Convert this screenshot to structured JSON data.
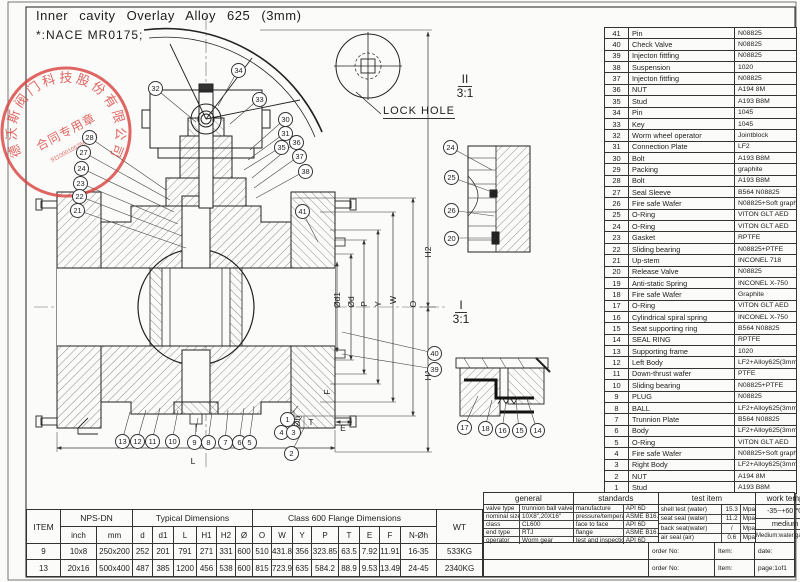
{
  "notes": {
    "line1": "Inner cavity Overlay Alloy 625 (3mm)",
    "line2": "*:NACE MR0175;"
  },
  "stamp": {
    "ring_text": "德沃斯阀门科技股份有限公司",
    "center_text": "合同专用章",
    "number_text": "91100010525062Z7",
    "color": "#d9413d"
  },
  "drawing": {
    "lock_hole_label": "LOCK HOLE",
    "detail_ii": {
      "name": "II",
      "scale": "3:1"
    },
    "detail_i": {
      "name": "I",
      "scale": "3:1"
    },
    "dim_labels": [
      {
        "t": "Ød1",
        "x": 337,
        "y": 300,
        "rot": 1
      },
      {
        "t": "Ød",
        "x": 351,
        "y": 302,
        "rot": 1
      },
      {
        "t": "P",
        "x": 364,
        "y": 304,
        "rot": 1
      },
      {
        "t": "Y",
        "x": 378,
        "y": 304,
        "rot": 1
      },
      {
        "t": "W",
        "x": 393,
        "y": 300,
        "rot": 1
      },
      {
        "t": "O",
        "x": 413,
        "y": 304,
        "rot": 1
      },
      {
        "t": "H2",
        "x": 428,
        "y": 252,
        "rot": 1
      },
      {
        "t": "H1",
        "x": 428,
        "y": 375,
        "rot": 1
      },
      {
        "t": "N-Øh",
        "x": 297,
        "y": 426,
        "rot": 1
      },
      {
        "t": "F",
        "x": 327,
        "y": 392,
        "rot": 1
      },
      {
        "t": "T",
        "x": 311,
        "y": 422,
        "rot": 0
      },
      {
        "t": "E",
        "x": 343,
        "y": 428,
        "rot": 0
      },
      {
        "t": "L",
        "x": 193,
        "y": 461,
        "rot": 0
      }
    ],
    "balloons": [
      {
        "n": 32,
        "x": 155,
        "y": 88,
        "tx": 196,
        "ty": 122
      },
      {
        "n": 34,
        "x": 238,
        "y": 70,
        "tx": 218,
        "ty": 106
      },
      {
        "n": 33,
        "x": 259,
        "y": 99,
        "tx": 230,
        "ty": 124
      },
      {
        "n": 28,
        "x": 89,
        "y": 137,
        "tx": 166,
        "ty": 190
      },
      {
        "n": 27,
        "x": 83,
        "y": 152,
        "tx": 170,
        "ty": 200
      },
      {
        "n": 24,
        "x": 81,
        "y": 168,
        "tx": 174,
        "ty": 212
      },
      {
        "n": 23,
        "x": 80,
        "y": 183,
        "tx": 178,
        "ty": 224
      },
      {
        "n": 22,
        "x": 79,
        "y": 196,
        "tx": 182,
        "ty": 236
      },
      {
        "n": 21,
        "x": 77,
        "y": 210,
        "tx": 186,
        "ty": 248
      },
      {
        "n": 30,
        "x": 285,
        "y": 119,
        "tx": 250,
        "ty": 150
      },
      {
        "n": 31,
        "x": 285,
        "y": 133,
        "tx": 248,
        "ty": 160
      },
      {
        "n": 35,
        "x": 281,
        "y": 147,
        "tx": 244,
        "ty": 170
      },
      {
        "n": 36,
        "x": 296,
        "y": 142,
        "tx": 252,
        "ty": 178
      },
      {
        "n": 37,
        "x": 299,
        "y": 156,
        "tx": 254,
        "ty": 188
      },
      {
        "n": 38,
        "x": 305,
        "y": 171,
        "tx": 256,
        "ty": 198
      },
      {
        "n": 41,
        "x": 302,
        "y": 211,
        "tx": 318,
        "ty": 242
      },
      {
        "n": 40,
        "x": 434,
        "y": 353,
        "tx": 342,
        "ty": 332
      },
      {
        "n": 39,
        "x": 434,
        "y": 369,
        "tx": 342,
        "ty": 354
      },
      {
        "n": 13,
        "x": 122,
        "y": 441,
        "tx": 130,
        "ty": 412
      },
      {
        "n": 12,
        "x": 137,
        "y": 441,
        "tx": 146,
        "ty": 410
      },
      {
        "n": 11,
        "x": 152,
        "y": 441,
        "tx": 160,
        "ty": 408
      },
      {
        "n": 10,
        "x": 172,
        "y": 441,
        "tx": 178,
        "ty": 410
      },
      {
        "n": 9,
        "x": 194,
        "y": 442,
        "tx": 198,
        "ty": 418
      },
      {
        "n": 8,
        "x": 208,
        "y": 442,
        "tx": 212,
        "ty": 412
      },
      {
        "n": 7,
        "x": 225,
        "y": 442,
        "tx": 228,
        "ty": 410
      },
      {
        "n": 6,
        "x": 239,
        "y": 442,
        "tx": 244,
        "ty": 408
      },
      {
        "n": 5,
        "x": 249,
        "y": 442,
        "tx": 254,
        "ty": 406
      },
      {
        "n": 4,
        "x": 281,
        "y": 432,
        "tx": 292,
        "ty": 414
      },
      {
        "n": 3,
        "x": 293,
        "y": 432,
        "tx": 302,
        "ty": 416
      },
      {
        "n": 1,
        "x": 287,
        "y": 419,
        "tx": 298,
        "ty": 406
      },
      {
        "n": 2,
        "x": 291,
        "y": 453,
        "tx": 304,
        "ty": 428
      },
      {
        "n": 24,
        "x": 450,
        "y": 147,
        "tx": 492,
        "ty": 170
      },
      {
        "n": 25,
        "x": 451,
        "y": 177,
        "tx": 492,
        "ty": 192
      },
      {
        "n": 26,
        "x": 451,
        "y": 210,
        "tx": 494,
        "ty": 216
      },
      {
        "n": 20,
        "x": 451,
        "y": 238,
        "tx": 496,
        "ty": 238
      },
      {
        "n": 17,
        "x": 464,
        "y": 427,
        "tx": 478,
        "ty": 396
      },
      {
        "n": 18,
        "x": 485,
        "y": 428,
        "tx": 492,
        "ty": 400
      },
      {
        "n": 16,
        "x": 502,
        "y": 430,
        "tx": 506,
        "ty": 402
      },
      {
        "n": 15,
        "x": 519,
        "y": 430,
        "tx": 516,
        "ty": 400
      },
      {
        "n": 14,
        "x": 537,
        "y": 430,
        "tx": 526,
        "ty": 396
      }
    ]
  },
  "parts_table": {
    "rows": [
      {
        "no": 41,
        "name": "Pin",
        "material": "N08825"
      },
      {
        "no": 40,
        "name": "Check Valve",
        "material": "N08825"
      },
      {
        "no": 39,
        "name": "Injecton fittfing",
        "material": "N08825"
      },
      {
        "no": 38,
        "name": "Suspension",
        "material": "1020"
      },
      {
        "no": 37,
        "name": "Injecton fittfing",
        "material": "N08825"
      },
      {
        "no": 36,
        "name": "NUT",
        "material": "A194 8M"
      },
      {
        "no": 35,
        "name": "Stud",
        "material": "A193 B8M"
      },
      {
        "no": 34,
        "name": "Pin",
        "material": "1045"
      },
      {
        "no": 33,
        "name": "Key",
        "material": "1045"
      },
      {
        "no": 32,
        "name": "Worm wheel operator",
        "material": "Jointblock"
      },
      {
        "no": 31,
        "name": "Connection Plate",
        "material": "LF2"
      },
      {
        "no": 30,
        "name": "Bolt",
        "material": "A193 B8M"
      },
      {
        "no": 29,
        "name": "Packing",
        "material": "graphite"
      },
      {
        "no": 28,
        "name": "Bolt",
        "material": "A193 B8M"
      },
      {
        "no": 27,
        "name": "Seal Sleeve",
        "material": "B564 N08825"
      },
      {
        "no": 26,
        "name": "Fire safe Wafer",
        "material": "N08825+Soft graphite"
      },
      {
        "no": 25,
        "name": "O-Ring",
        "material": "VITON GLT AED"
      },
      {
        "no": 24,
        "name": "O-Ring",
        "material": "VITON GLT AED"
      },
      {
        "no": 23,
        "name": "Gasket",
        "material": "RPTFE"
      },
      {
        "no": 22,
        "name": "Sliding bearing",
        "material": "N08825+PTFE"
      },
      {
        "no": 21,
        "name": "Up-stem",
        "material": "INCONEL 718"
      },
      {
        "no": 20,
        "name": "Release Valve",
        "material": "N08825"
      },
      {
        "no": 19,
        "name": "Anti-static Spring",
        "material": "INCONEL X-750"
      },
      {
        "no": 18,
        "name": "Fire safe Wafer",
        "material": "Graphite"
      },
      {
        "no": 17,
        "name": "O-Ring",
        "material": "VITON GLT AED"
      },
      {
        "no": 16,
        "name": "Cylindrical spiral spring",
        "material": "INCONEL X-750"
      },
      {
        "no": 15,
        "name": "Seat supporting ring",
        "material": "B564 N08825"
      },
      {
        "no": 14,
        "name": "SEAL RING",
        "material": "RPTFE"
      },
      {
        "no": 13,
        "name": "Supporting frame",
        "material": "1020"
      },
      {
        "no": 12,
        "name": "Left Body",
        "material": "LF2+Alloy625(3mm)"
      },
      {
        "no": 11,
        "name": "Down-thrust wafer",
        "material": "PTFE"
      },
      {
        "no": 10,
        "name": "Sliding bearing",
        "material": "N08825+PTFE"
      },
      {
        "no": 9,
        "name": "PLUG",
        "material": "N08825"
      },
      {
        "no": 8,
        "name": "BALL",
        "material": "LF2+Alloy625(3mm)"
      },
      {
        "no": 7,
        "name": "Trunnion Plate",
        "material": "B564 N08825"
      },
      {
        "no": 6,
        "name": "Body",
        "material": "LF2+Alloy625(3mm)"
      },
      {
        "no": 5,
        "name": "O-Ring",
        "material": "VITON GLT AED"
      },
      {
        "no": 4,
        "name": "Fire safe Wafer",
        "material": "N08825+Soft graphite"
      },
      {
        "no": 3,
        "name": "Right Body",
        "material": "LF2+Alloy625(3mm)"
      },
      {
        "no": 2,
        "name": "NUT",
        "material": "A194 8M"
      },
      {
        "no": 1,
        "name": "Stud",
        "material": "A193 B8M"
      }
    ]
  },
  "dimension_table": {
    "item_header": "ITEM",
    "wt_header": "WT",
    "group_headers": {
      "nps": "NPS-DN",
      "typical": "Typical Dimensions",
      "class600": "Class 600 Flange Dimensions"
    },
    "sub_headers": [
      "inch",
      "mm",
      "d",
      "d1",
      "L",
      "H1",
      "H2",
      "Ø",
      "O",
      "W",
      "Y",
      "P",
      "T",
      "E",
      "F",
      "N-Øh"
    ],
    "rows": [
      {
        "item": "9",
        "cells": [
          "10x8",
          "250x200",
          "252",
          "201",
          "791",
          "271",
          "331",
          "600",
          "510",
          "431.8",
          "356",
          "323.85",
          "63.5",
          "7.92",
          "11.91",
          "16-35"
        ],
        "wt": "533KG"
      },
      {
        "item": "13",
        "cells": [
          "20x16",
          "500x400",
          "487",
          "385",
          "1200",
          "456",
          "538",
          "600",
          "815",
          "723.9",
          "635",
          "584.2",
          "88.9",
          "9.53",
          "13.49",
          "24-45"
        ],
        "wt": "2340KG"
      }
    ]
  },
  "info_table": {
    "general": {
      "header": "general",
      "rows": [
        [
          "valve type",
          "trunnion ball valve"
        ],
        [
          "nominal size",
          "10X8\",20X16\""
        ],
        [
          "class",
          "CL600"
        ],
        [
          "end type",
          "RTJ"
        ],
        [
          "operator",
          "Worm gear"
        ]
      ]
    },
    "standards": {
      "header": "standards",
      "rows": [
        [
          "manufacture",
          "API 6D"
        ],
        [
          "pressure/temperature",
          "ASME B16.34"
        ],
        [
          "face to face",
          "API 6D"
        ],
        [
          "flange",
          "ASME B16.5"
        ],
        [
          "test and inspection",
          "API 6D"
        ]
      ]
    },
    "test": {
      "header": "test item",
      "rows": [
        [
          "shell test (water)",
          "15.3",
          "Mpa"
        ],
        [
          "seat seal (water)",
          "11.2",
          "Mpa"
        ],
        [
          "back seat(water)",
          "/",
          "Mpa"
        ],
        [
          "air seal (air)",
          "0.6",
          "Mpa"
        ]
      ]
    },
    "work_temp": {
      "header": "work temp",
      "value": "-35~+60  ℃",
      "medium_header": "medium",
      "medium_value": "Medium:water,gas,oil."
    },
    "order_rows": [
      [
        "order No:",
        "Item:",
        "date:"
      ],
      [
        "order No:",
        "Item:",
        "page:1of1"
      ]
    ]
  }
}
